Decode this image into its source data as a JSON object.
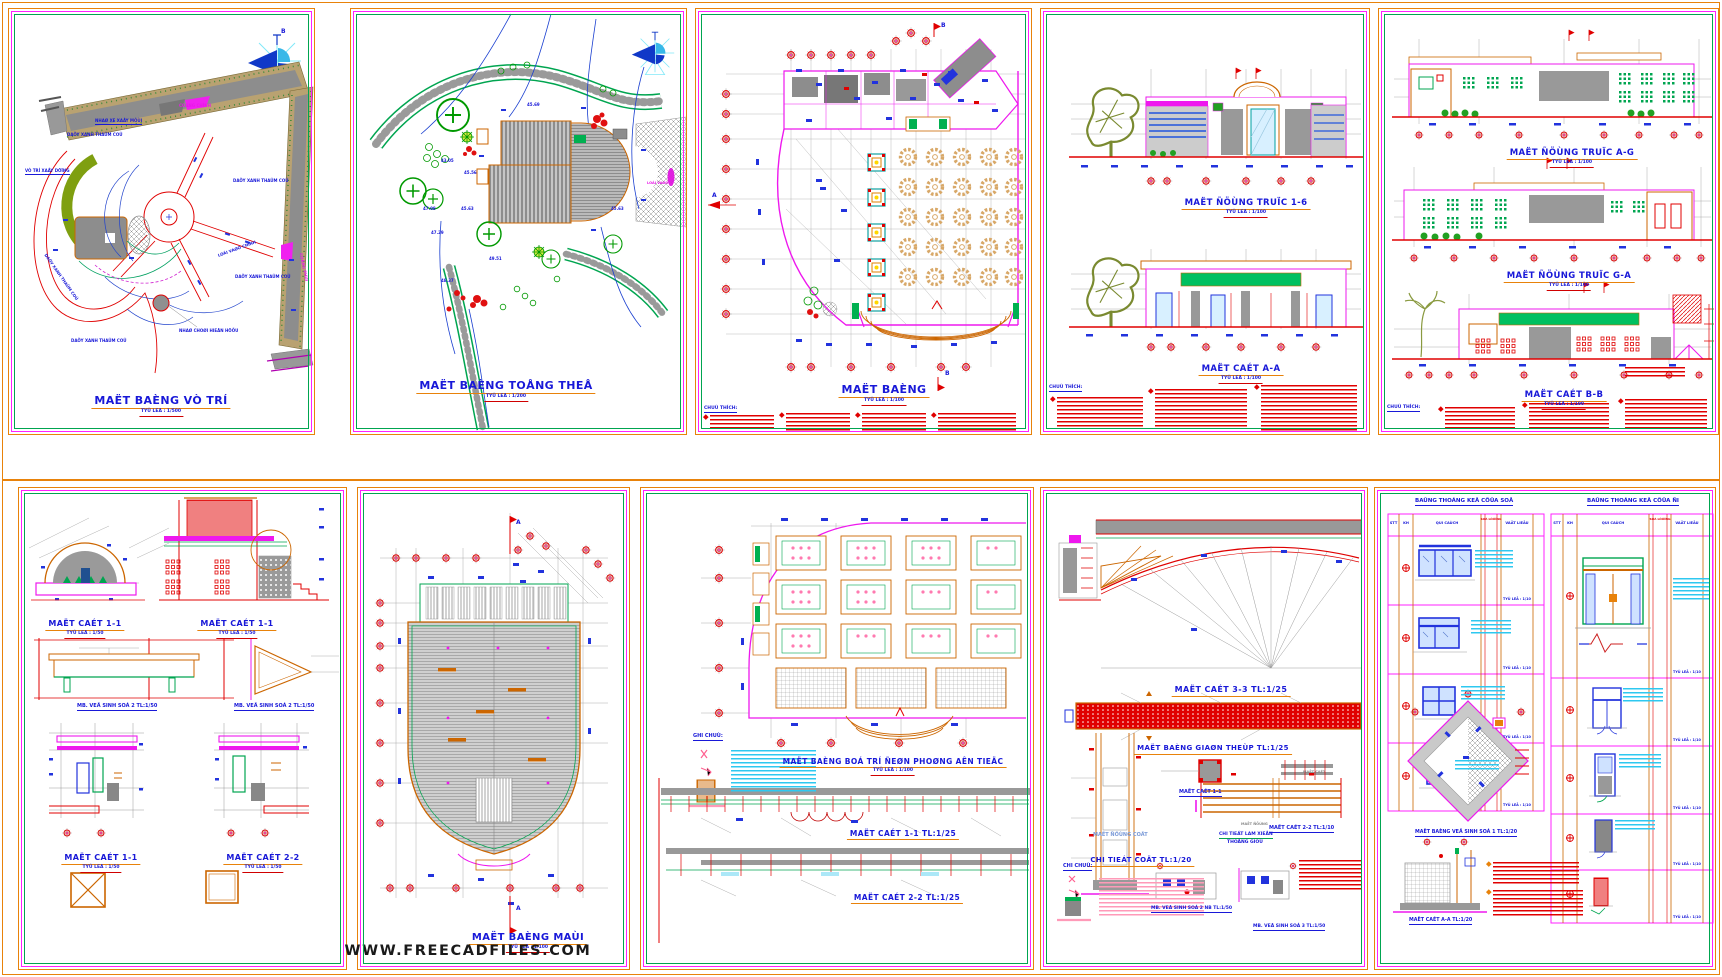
{
  "page": {
    "watermark": "WWW.FREECADFILES.COM"
  },
  "common": {
    "note_header": "CHUÙ THÍCH:",
    "ghi_chu": "GHI CHUÙ:",
    "chi_chu": "CHI CHUÙ:",
    "north": "B"
  },
  "s1": {
    "title": "MAËT BAÈNG VÒ TRÍ",
    "scale": "TYÛ LEÄ : 1/500",
    "lbl_nha_xe": "NHAØ XE XAÂY MÔÙI",
    "lbl_day_xanh": "DAÕY XANH THAÛM COÛ",
    "lbl_vi_tri": "VÒ TRÍ XAÂY DÖÏNG",
    "lbl_cong_chinh": "COÅNG CHÍNH",
    "lbl_cong_phu": "COÅNG PHUÏ",
    "lbl_loi_vao": "LOÁI VAØO CHÍNH",
    "lbl_nha_choi": "NHAØ CHOØI HIEÄN HÖÕU"
  },
  "s2": {
    "title": "MAËT BAÈNG TOÅNG THEÅ",
    "scale": "TYÛ LEÄ : 1/200",
    "spot1": "45.69",
    "spot2": "43.05",
    "spot3": "45.56",
    "spot4": "47.08",
    "spot5": "45.63",
    "spot6": "47.29",
    "spot7": "49.51",
    "spot8": "48.37",
    "spot9": "45.63",
    "lbl_loi_vao": "LOÁI VAØO"
  },
  "s3": {
    "title": "MAËT BAÈNG",
    "scale": "TYÛ LEÄ : 1/100",
    "mk_a": "A",
    "mk_b": "B"
  },
  "s4": {
    "title1": "MAËT ÑÖÙNG TRUÏC 1-6",
    "title2": "MAËT CAÉT A-A",
    "scale": "TYÛ LEÄ : 1/100"
  },
  "s5": {
    "title1": "MAËT ÑÖÙNG TRUÏC A-G",
    "title2": "MAËT ÑÖÙNG TRUÏC G-A",
    "title3": "MAËT CAÉT B-B",
    "scale": "TYÛ LEÄ : 1/100"
  },
  "s6": {
    "title_dome": "MAËT CAÉT 1-1",
    "title_wall": "MAËT CAÉT 1-1",
    "title_wc2a": "MB. VEÄ SINH SOÁ 2 TL:1/50",
    "title_wc2b": "MB. VEÄ SINH SOÁ 2 TL:1/50",
    "title_sec11": "MAËT CAÉT 1-1",
    "title_sec22": "MAËT CAÉT 2-2",
    "scale": "TYÛ LEÄ : 1/50"
  },
  "s7": {
    "title": "MAËT BAÈNG MAÙI",
    "scale": "TYÛ LEÄ : 1/100",
    "flag": "A"
  },
  "s8": {
    "title": "MAËT BAÈNG BOÁ TRÍ ÑEØN PHOØNG AÊN TIEÄC",
    "scale": "TYÛ LEÄ : 1/100",
    "title_sec1": "MAËT CAÉT 1-1 TL:1/25",
    "title_sec2": "MAËT CAÉT 2-2 TL:1/25"
  },
  "s9": {
    "title_sec33": "MAËT CAÉT 3-3 TL:1/25",
    "title_truss": "MAËT BAÈNG GIAØN THEÙP TL:1/25",
    "title_sec11": "MAËT CAÉT 1-1",
    "title_sec22": "MAËT CAÉT 2-2 TL:1/10",
    "lbl_col": "MAËT ÑÖÙNG COÄT",
    "title_col": "CHI TIEÁT COÄT TL:1/20",
    "lbl_md": "MAËT ÑÖÙNG",
    "lbl_mc": "MAËT CAÉT",
    "title_lam1": "CHI TIEÁT LAM XIEÂN",
    "title_lam2": "THOÂNG GIOÙ",
    "title_wc2": "MB. VEÄ SINH SOÁ 2 NB TL:1/50",
    "title_wc3": "MB. VEÄ SINH SOÁ 3 TL:1/50"
  },
  "s10": {
    "win_title": "BAÛNG THOÁNG KEÂ CÖÛA SOÅ",
    "door_title": "BAÛNG THOÁNG KEÂ CÖÛA ÑI",
    "h_stt": "STT",
    "h_kh": "KH",
    "h_quicach": "QUI CAÙCH",
    "h_soluong": "SOÁ LÖÔÏNG",
    "h_vatlieu": "VAÄT LIEÄU",
    "row_scale": "TYÛ LEÄ : 1/10",
    "title_plan": "MAËT BAÈNG VEÄ SINH SOÁ 1 TL:1/20",
    "title_sec": "MAËT CAÉT A-A TL:1/20"
  }
}
